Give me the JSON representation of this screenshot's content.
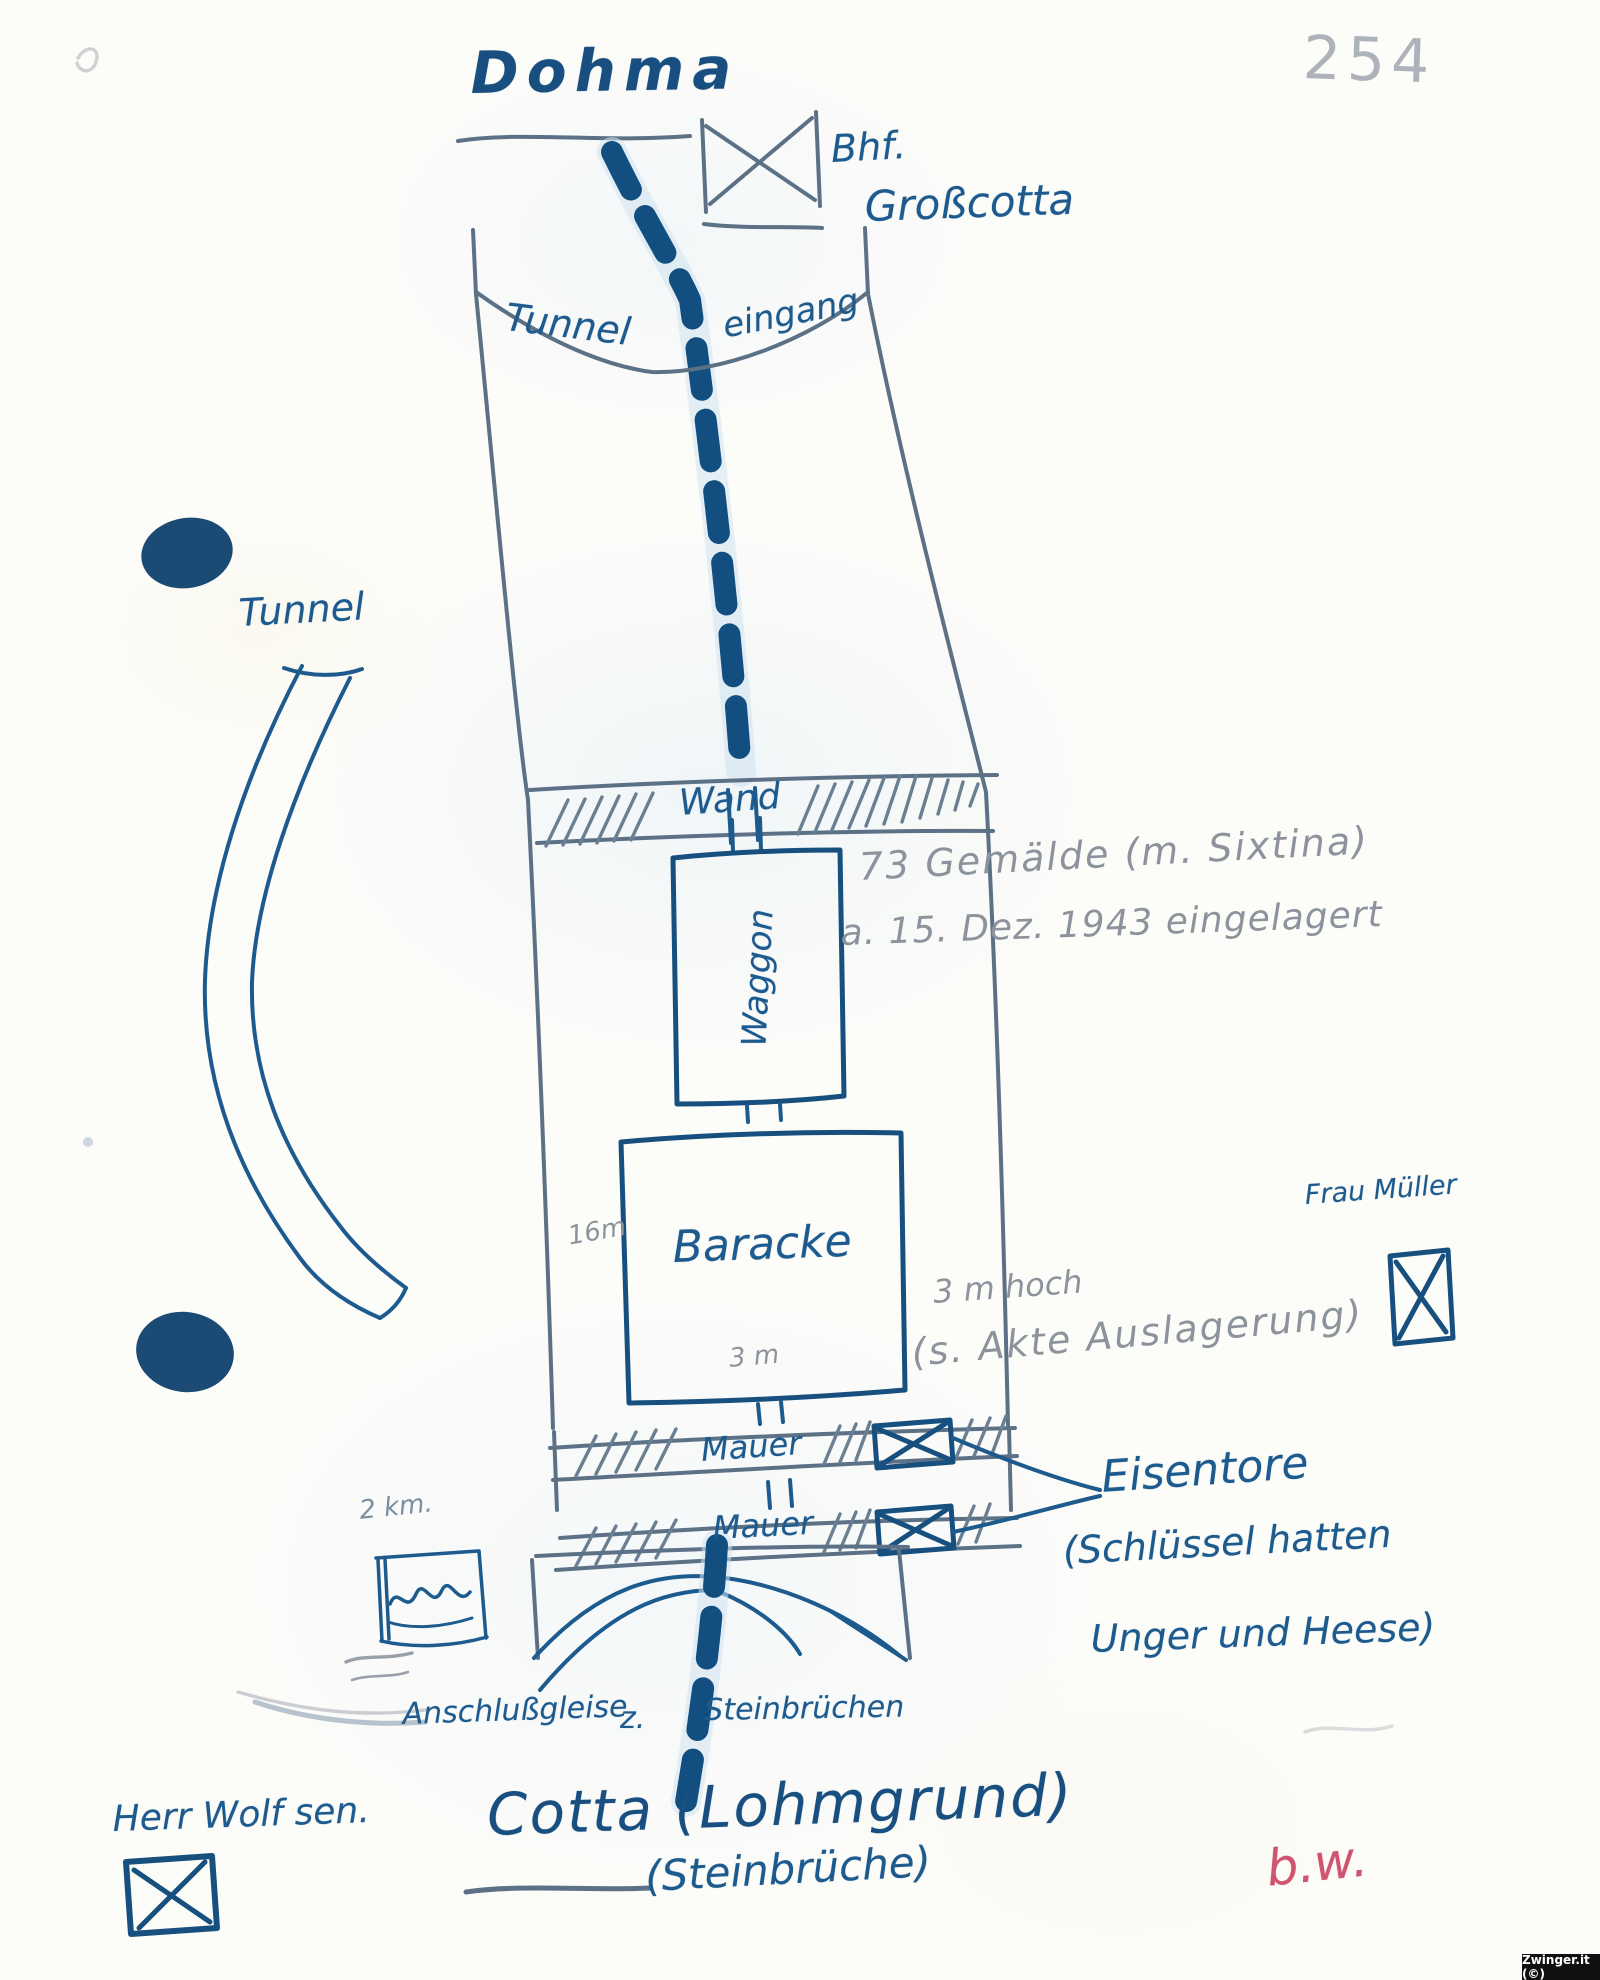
{
  "page": {
    "number": "254",
    "reverse_note": "b.w.",
    "watermark": "Zwinger.it (©)"
  },
  "colors": {
    "ink": "#1d5a8e",
    "ink_dark": "#17507f",
    "structure_line": "#5c7186",
    "pencil": "#8d939c",
    "red_note": "#cf5470",
    "ink_blot": "#1b4a75",
    "paper": "#fcfcf9"
  },
  "top": {
    "title": "Dohma",
    "station_line1": "Bhf.",
    "station_line2": "Großcotta",
    "station_symbol": "crossed-box"
  },
  "tunnel": {
    "entrance_word1": "Tunnel",
    "entrance_word2": "eingang",
    "side_tunnel_label": "Tunnel",
    "wand_label": "Wand",
    "waggon_label": "Waggon",
    "baracke_label": "Baracke",
    "mauer1_label": "Mauer",
    "mauer2_label": "Mauer"
  },
  "annotations": {
    "gemaelde_line1": "73 Gemälde (m. Sixtina)",
    "gemaelde_line2": "a. 15. Dez. 1943 eingelagert",
    "baracke_width": "16m",
    "baracke_depth": "3 m",
    "height_line1": "3 m hoch",
    "height_line2": "(s. Akte Auslagerung)",
    "distance_note": "2 km.",
    "frau_mueller": "Frau Müller",
    "herr_wolf": "Herr Wolf sen.",
    "eisentore_line1": "Eisentore",
    "eisentore_line2": "(Schlüssel hatten",
    "eisentore_line3": "Unger und Heese)"
  },
  "bottom": {
    "gleise_part1": "Anschlußgleise",
    "gleise_part2": "z.",
    "gleise_part3": "Steinbrüchen",
    "title": "Cotta (Lohmgrund)",
    "subtitle": "(Steinbrüche)"
  }
}
